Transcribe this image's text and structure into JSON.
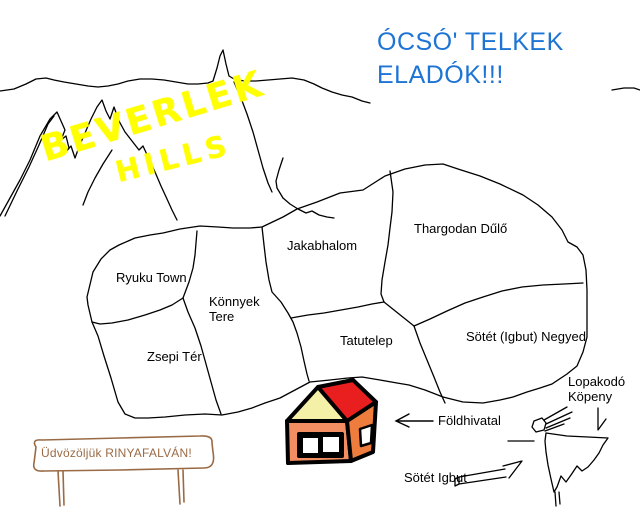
{
  "headline": {
    "line1": "ÓCSÓ' TELKEK",
    "line2": "ELADÓK!!!"
  },
  "mountains": {
    "name_line1": "BEVERLEK",
    "name_line2": "HILLS"
  },
  "map": {
    "regions": [
      {
        "name": "Ryuku Town"
      },
      {
        "name": "Könnyek Tere"
      },
      {
        "name": "Zsepi Tér"
      },
      {
        "name": "Jakabhalom"
      },
      {
        "name": "Thargodan Dűlő"
      },
      {
        "name": "Tatutelep"
      },
      {
        "name": "Sötét (Igbut) Negyed"
      }
    ]
  },
  "annotations": {
    "land_office": "Földhivatal",
    "dark_igbut": "Sötét Igbut",
    "cloak": "Lopakodó Köpeny"
  },
  "sign": {
    "text": "Üdvözöljük RINYAFALVÁN!"
  },
  "colors": {
    "blue": "#1d74d4",
    "yellow": "#ffff00",
    "brown": "#9a6a45",
    "ink": "#000000",
    "house_wall": "#f28e62",
    "house_wall_side": "#ee7c3c",
    "house_roof": "#e91e1e",
    "house_gable": "#f5f0a8"
  }
}
